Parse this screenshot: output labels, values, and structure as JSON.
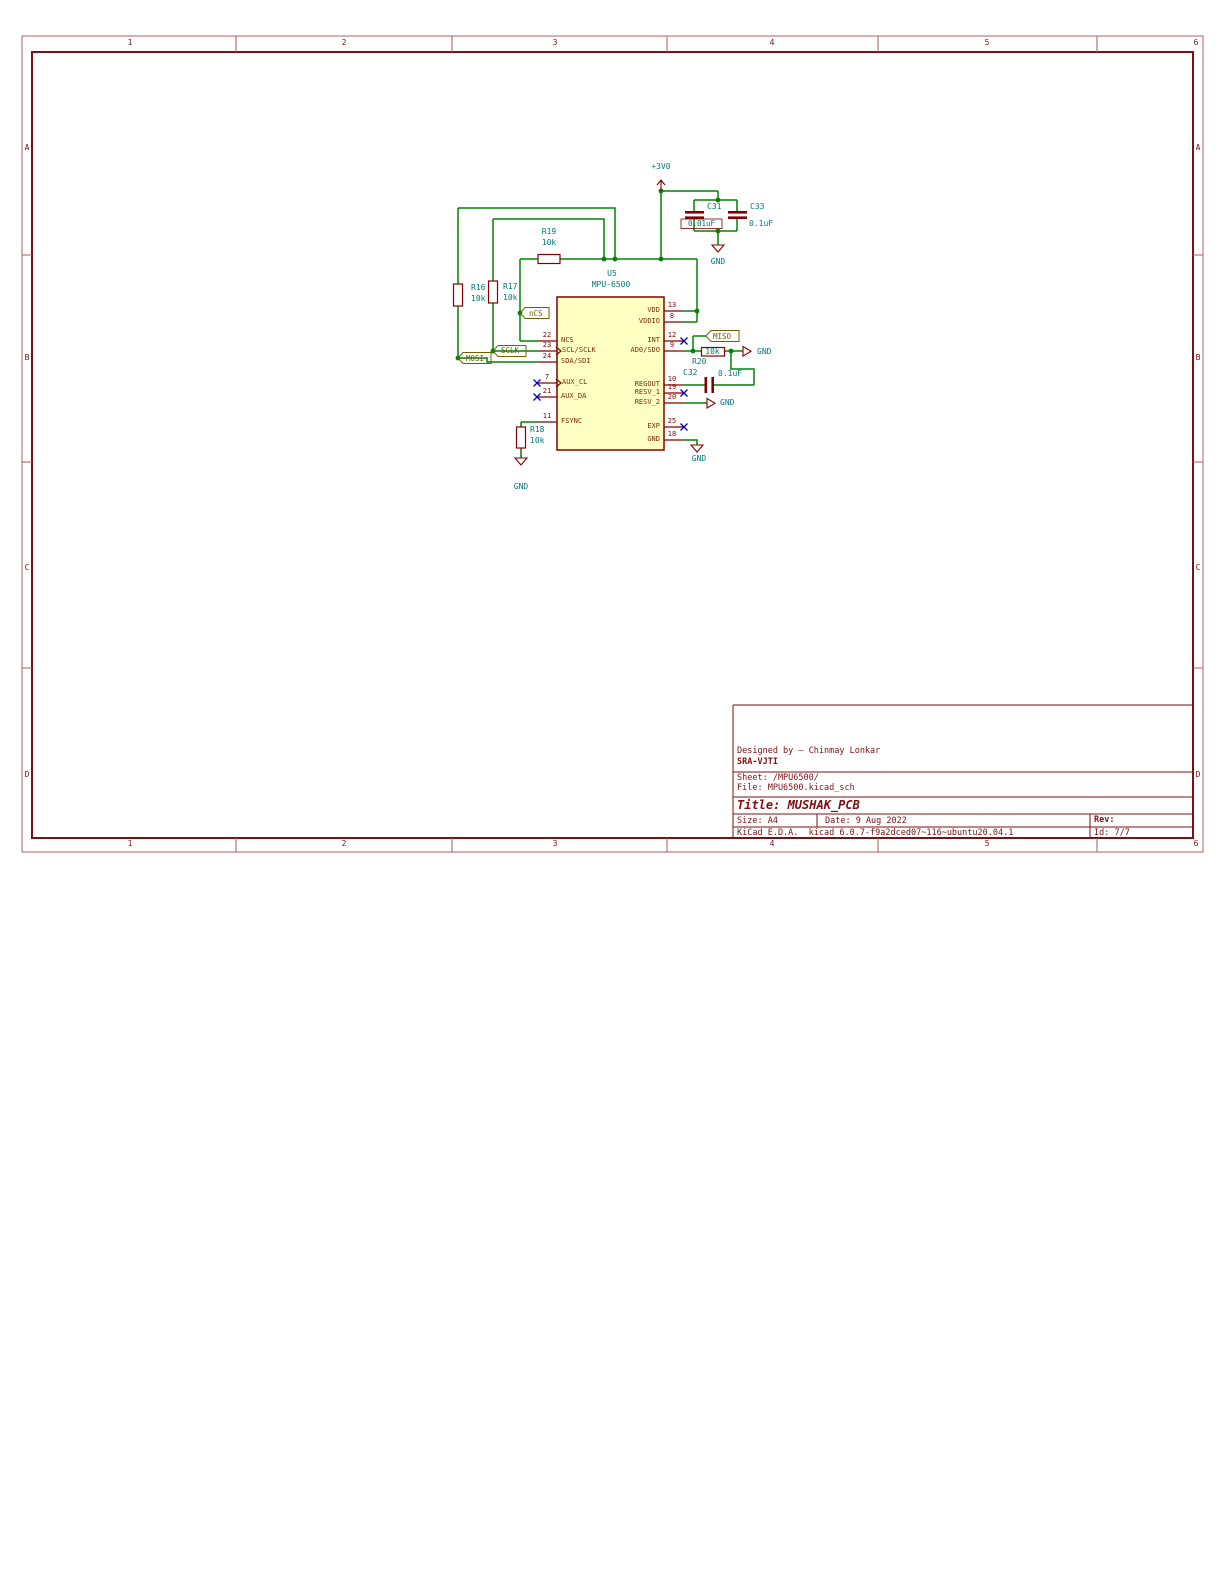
{
  "sheet": {
    "frame": {
      "columns": [
        "1",
        "2",
        "3",
        "4",
        "5",
        "6"
      ],
      "rows": [
        "A",
        "B",
        "C",
        "D"
      ]
    },
    "title_block": {
      "designed_by": "Designed by – Chinmay Lonkar",
      "org": "SRA-VJTI",
      "sheet_label": "Sheet: /MPU6500/",
      "file_label": "File: MPU6500.kicad_sch",
      "title_label": "Title: MUSHAK_PCB",
      "size_label": "Size: A4",
      "date_label": "Date: 9 Aug 2022",
      "rev_label": "Rev:",
      "generator_label": "KiCad E.D.A.  kicad 6.0.7-f9a2dced07~116~ubuntu20.04.1",
      "id_label": "Id: 7/7"
    }
  },
  "schematic": {
    "power": {
      "v3": "+3V0",
      "gnd": "GND"
    },
    "ic": {
      "ref": "U5",
      "value": "MPU-6500",
      "pins_left": [
        {
          "num": "22",
          "name": "NCS"
        },
        {
          "num": "23",
          "name": "SCL/SCLK"
        },
        {
          "num": "24",
          "name": "SDA/SDI"
        },
        {
          "num": "7",
          "name": "AUX_CL"
        },
        {
          "num": "21",
          "name": "AUX_DA"
        },
        {
          "num": "11",
          "name": "FSYNC"
        }
      ],
      "pins_right": [
        {
          "num": "13",
          "name": "VDD"
        },
        {
          "num": "8",
          "name": "VDDIO"
        },
        {
          "num": "12",
          "name": "INT"
        },
        {
          "num": "9",
          "name": "AD0/SDO"
        },
        {
          "num": "10",
          "name": "REGOUT"
        },
        {
          "num": "19",
          "name": "RESV_1"
        },
        {
          "num": "20",
          "name": "RESV_2"
        },
        {
          "num": "25",
          "name": "EXP"
        },
        {
          "num": "18",
          "name": "GND"
        }
      ]
    },
    "r16": {
      "ref": "R16",
      "value": "10k"
    },
    "r17": {
      "ref": "R17",
      "value": "10k"
    },
    "r18": {
      "ref": "R18",
      "value": "10k"
    },
    "r19": {
      "ref": "R19",
      "value": "10k"
    },
    "r20": {
      "ref": "R20",
      "value": "10k"
    },
    "c31": {
      "ref": "C31",
      "value": "0.01uF"
    },
    "c32": {
      "ref": "C32",
      "value": "0.1uF"
    },
    "c33": {
      "ref": "C33",
      "value": "0.1uF"
    },
    "labels": {
      "ncs": "nCS",
      "sclk": "SCLK",
      "mosi": "MOSI",
      "miso": "MISO"
    },
    "colors": {
      "wire": "#008400",
      "symbol": "#840000",
      "reference": "#007878",
      "global_label": "#6e6100",
      "frame": "#7c1013",
      "no_connect": "#0000c8",
      "ic_fill": "#ffffc2"
    }
  }
}
